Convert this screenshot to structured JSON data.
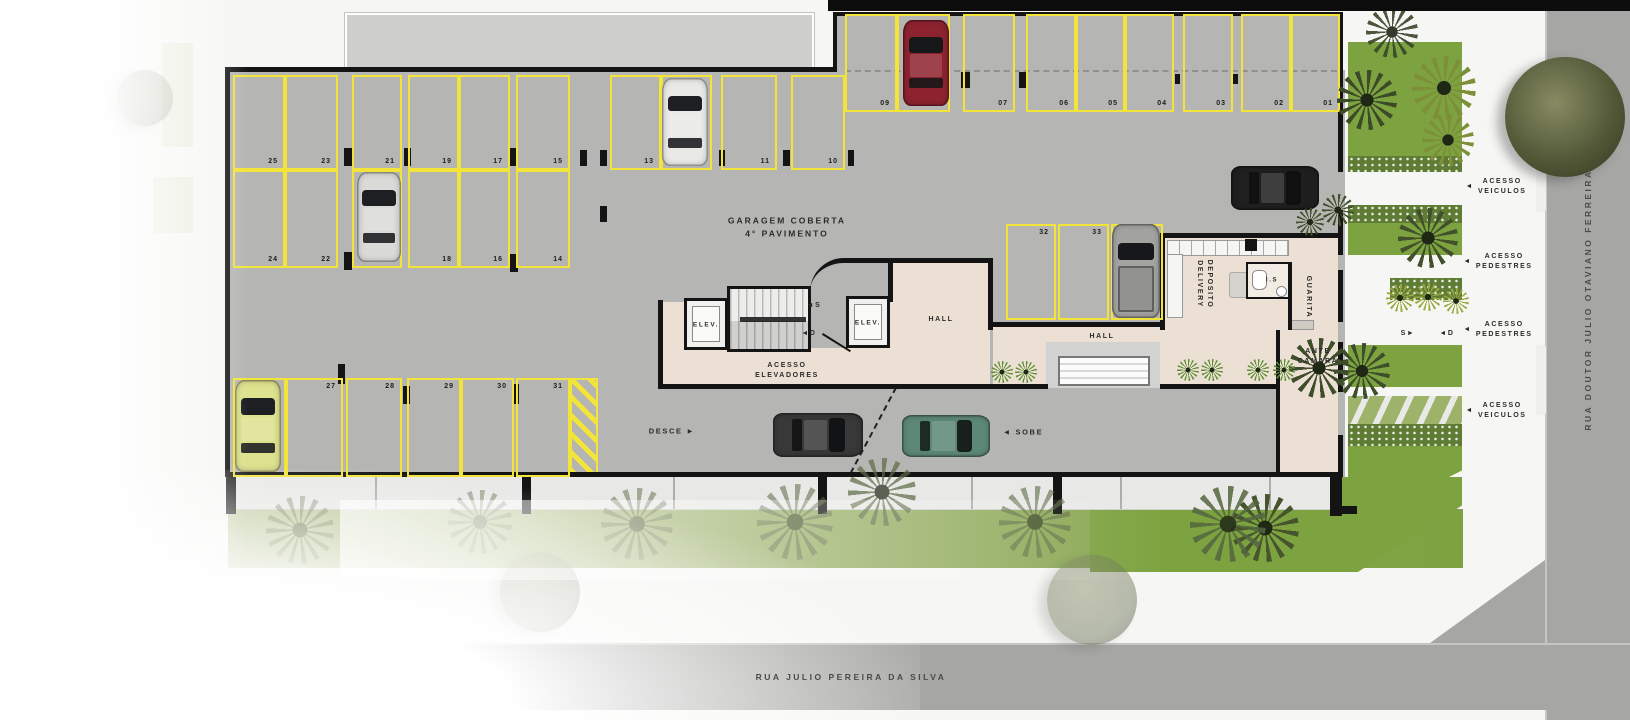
{
  "title": {
    "line1": "GARAGEM COBERTA",
    "line2": "4° PAVIMENTO"
  },
  "streets": {
    "bottom": "RUA JULIO PEREIRA DA SILVA",
    "right": "RUA DOUTOR JULIO OTAVIANO FERREIRA"
  },
  "colors": {
    "parking_line": "#f2e438",
    "floor": "#b5b5b3",
    "interior_floor": "#ebe0d3",
    "lawn": "#7da340",
    "hedge": "#5e7c33",
    "street": "#a6a6a4",
    "wall": "#141414"
  },
  "parking": {
    "spaces": [
      {
        "n": "25",
        "x": 233,
        "y": 75,
        "w": 52,
        "h": 95,
        "lp": "br"
      },
      {
        "n": "23",
        "x": 285,
        "y": 75,
        "w": 53,
        "h": 95,
        "lp": "br"
      },
      {
        "n": "21",
        "x": 352,
        "y": 75,
        "w": 50,
        "h": 95,
        "lp": "br"
      },
      {
        "n": "19",
        "x": 408,
        "y": 75,
        "w": 51,
        "h": 95,
        "lp": "br"
      },
      {
        "n": "17",
        "x": 459,
        "y": 75,
        "w": 51,
        "h": 95,
        "lp": "br"
      },
      {
        "n": "15",
        "x": 516,
        "y": 75,
        "w": 54,
        "h": 95,
        "lp": "br"
      },
      {
        "n": "13",
        "x": 610,
        "y": 75,
        "w": 51,
        "h": 95,
        "lp": "br"
      },
      {
        "n": "12",
        "x": 661,
        "y": 75,
        "w": 51,
        "h": 95,
        "lp": "br"
      },
      {
        "n": "11",
        "x": 721,
        "y": 75,
        "w": 56,
        "h": 95,
        "lp": "br"
      },
      {
        "n": "10",
        "x": 791,
        "y": 75,
        "w": 54,
        "h": 95,
        "lp": "br"
      },
      {
        "n": "24",
        "x": 233,
        "y": 170,
        "w": 52,
        "h": 98,
        "lp": "br"
      },
      {
        "n": "22",
        "x": 285,
        "y": 170,
        "w": 53,
        "h": 98,
        "lp": "br"
      },
      {
        "n": "20",
        "x": 352,
        "y": 170,
        "w": 50,
        "h": 98,
        "lp": "br"
      },
      {
        "n": "18",
        "x": 408,
        "y": 170,
        "w": 51,
        "h": 98,
        "lp": "br"
      },
      {
        "n": "16",
        "x": 459,
        "y": 170,
        "w": 51,
        "h": 98,
        "lp": "br"
      },
      {
        "n": "14",
        "x": 516,
        "y": 170,
        "w": 54,
        "h": 98,
        "lp": "br"
      },
      {
        "n": "26",
        "x": 233,
        "y": 378,
        "w": 53,
        "h": 99,
        "lp": "tr"
      },
      {
        "n": "27",
        "x": 286,
        "y": 378,
        "w": 57,
        "h": 99,
        "lp": "tr"
      },
      {
        "n": "28",
        "x": 346,
        "y": 378,
        "w": 56,
        "h": 99,
        "lp": "tr"
      },
      {
        "n": "29",
        "x": 407,
        "y": 378,
        "w": 54,
        "h": 99,
        "lp": "tr"
      },
      {
        "n": "30",
        "x": 461,
        "y": 378,
        "w": 53,
        "h": 99,
        "lp": "tr"
      },
      {
        "n": "31",
        "x": 516,
        "y": 378,
        "w": 54,
        "h": 99,
        "lp": "tr"
      },
      {
        "n": "32",
        "x": 1006,
        "y": 224,
        "w": 50,
        "h": 96,
        "lp": "tr"
      },
      {
        "n": "33",
        "x": 1058,
        "y": 224,
        "w": 51,
        "h": 96,
        "lp": "tr"
      },
      {
        "n": "34",
        "x": 1111,
        "y": 224,
        "w": 52,
        "h": 96,
        "lp": "tr"
      },
      {
        "n": "09",
        "x": 845,
        "y": 14,
        "w": 52,
        "h": 98,
        "lp": "br"
      },
      {
        "n": "08",
        "x": 897,
        "y": 14,
        "w": 53,
        "h": 98,
        "lp": "br"
      },
      {
        "n": "07",
        "x": 963,
        "y": 14,
        "w": 52,
        "h": 98,
        "lp": "br"
      },
      {
        "n": "06",
        "x": 1026,
        "y": 14,
        "w": 50,
        "h": 98,
        "lp": "br"
      },
      {
        "n": "05",
        "x": 1076,
        "y": 14,
        "w": 49,
        "h": 98,
        "lp": "br"
      },
      {
        "n": "04",
        "x": 1125,
        "y": 14,
        "w": 49,
        "h": 98,
        "lp": "br"
      },
      {
        "n": "03",
        "x": 1183,
        "y": 14,
        "w": 50,
        "h": 98,
        "lp": "br"
      },
      {
        "n": "02",
        "x": 1241,
        "y": 14,
        "w": 50,
        "h": 98,
        "lp": "br"
      },
      {
        "n": "01",
        "x": 1291,
        "y": 14,
        "w": 49,
        "h": 98,
        "lp": "br"
      }
    ]
  },
  "labels": [
    {
      "name": "elev-left-label",
      "text": "ELEV.",
      "x": 706,
      "y": 325,
      "size": 6.5
    },
    {
      "name": "elev-right-label",
      "text": "ELEV.",
      "x": 868,
      "y": 323,
      "size": 6.5
    },
    {
      "name": "stair-up-marker",
      "text": "◄S",
      "x": 814,
      "y": 306,
      "size": 7
    },
    {
      "name": "stair-down-marker",
      "text": "◄D",
      "x": 809,
      "y": 334,
      "size": 7
    },
    {
      "name": "acesso-elevadores-label",
      "lines": [
        "ACESSO",
        "ELEVADORES"
      ],
      "x": 787,
      "y": 371,
      "size": 7
    },
    {
      "name": "hall-label-1",
      "text": "HALL",
      "x": 941,
      "y": 320,
      "size": 7
    },
    {
      "name": "hall-label-2",
      "text": "HALL",
      "x": 1102,
      "y": 337,
      "size": 7
    },
    {
      "name": "deposito-delivery-label",
      "lines": [
        "DEPOSITO",
        "DELIVERY"
      ],
      "x": 1204,
      "y": 284,
      "rot": 90,
      "size": 7
    },
    {
      "name": "is-label",
      "text": "I.S",
      "x": 1272,
      "y": 281,
      "size": 6
    },
    {
      "name": "guarita-label",
      "text": "GUARITA",
      "x": 1308,
      "y": 297,
      "rot": 90,
      "size": 7
    },
    {
      "name": "ante-camara-label",
      "lines": [
        "ANTE",
        "CAMARA"
      ],
      "x": 1318,
      "y": 357,
      "size": 7
    },
    {
      "name": "desce-label",
      "text": "DESCE ►",
      "x": 672,
      "y": 432,
      "size": 7.5
    },
    {
      "name": "sobe-label",
      "text": "◄ SOBE",
      "x": 1023,
      "y": 433,
      "size": 7.5
    },
    {
      "name": "s-walk-marker",
      "text": "S►",
      "x": 1408,
      "y": 334,
      "size": 7
    },
    {
      "name": "d-walk-marker",
      "text": "◄D",
      "x": 1447,
      "y": 334,
      "size": 7
    },
    {
      "name": "acesso-veiculos-top-label",
      "lines": [
        "ACESSO",
        "VEICULOS"
      ],
      "x": 1496,
      "y": 187,
      "arrow": "◄",
      "size": 7
    },
    {
      "name": "acesso-pedestres-1-label",
      "lines": [
        "ACESSO",
        "PEDESTRES"
      ],
      "x": 1498,
      "y": 262,
      "arrow": "◄",
      "size": 7
    },
    {
      "name": "acesso-pedestres-2-label",
      "lines": [
        "ACESSO",
        "PEDESTRES"
      ],
      "x": 1498,
      "y": 330,
      "arrow": "◄",
      "size": 7
    },
    {
      "name": "acesso-veiculos-bottom-label",
      "lines": [
        "ACESSO",
        "VEICULOS"
      ],
      "x": 1496,
      "y": 411,
      "arrow": "◄",
      "size": 7
    }
  ],
  "cars": [
    {
      "name": "car-red-space-08",
      "x": 903,
      "y": 20,
      "w": 46,
      "h": 86,
      "rot": 0,
      "body": "#8e2330",
      "glass": "#17181a"
    },
    {
      "name": "car-white-space-12",
      "x": 662,
      "y": 78,
      "w": 46,
      "h": 88,
      "rot": 0,
      "body": "#e9e9e7",
      "glass": "#1d1f22"
    },
    {
      "name": "car-silver-space-20",
      "x": 357,
      "y": 172,
      "w": 44,
      "h": 90,
      "rot": 0,
      "body": "#dadad8",
      "glass": "#1d1f22"
    },
    {
      "name": "car-yellow-space-26",
      "x": 235,
      "y": 380,
      "w": 46,
      "h": 92,
      "rot": 0,
      "body": "#dee18e",
      "glass": "#1d1f22"
    },
    {
      "name": "pickup-gray-space-34",
      "x": 1112,
      "y": 224,
      "w": 48,
      "h": 94,
      "rot": 0,
      "body": "#a3a3a1",
      "glass": "#17181a",
      "type": "pickup"
    },
    {
      "name": "car-black-driving",
      "x": 1253,
      "y": 144,
      "w": 44,
      "h": 88,
      "rot": 90,
      "body": "#1f1f1f",
      "glass": "#101011"
    },
    {
      "name": "car-dark-ramp-desce",
      "x": 796,
      "y": 390,
      "w": 44,
      "h": 90,
      "rot": 90,
      "body": "#383838",
      "glass": "#121315"
    },
    {
      "name": "car-green-ramp-sobe",
      "x": 925,
      "y": 392,
      "w": 42,
      "h": 88,
      "rot": 90,
      "body": "#5d8876",
      "glass": "#17201c"
    }
  ],
  "trees": [
    {
      "name": "big-street-tree",
      "x": 1565,
      "y": 117,
      "r": 60,
      "kind": "round",
      "c": "#4e5434",
      "o": 1
    },
    {
      "name": "palm",
      "x": 1367,
      "y": 100,
      "r": 30,
      "kind": "palm",
      "c": "#3c4a28",
      "o": 1
    },
    {
      "name": "palm",
      "x": 1444,
      "y": 88,
      "r": 32,
      "kind": "palm",
      "c": "#7e8f39",
      "o": 1
    },
    {
      "name": "palm",
      "x": 1448,
      "y": 140,
      "r": 26,
      "kind": "palm",
      "c": "#7e8f39",
      "o": 1
    },
    {
      "name": "palm",
      "x": 1392,
      "y": 32,
      "r": 26,
      "kind": "palm",
      "c": "#39462a",
      "o": 0.9
    },
    {
      "name": "palm",
      "x": 1310,
      "y": 222,
      "r": 14,
      "kind": "palm",
      "c": "#42512b",
      "o": 1
    },
    {
      "name": "palm",
      "x": 1338,
      "y": 210,
      "r": 16,
      "kind": "palm",
      "c": "#42512b",
      "o": 1
    },
    {
      "name": "palm",
      "x": 1428,
      "y": 238,
      "r": 30,
      "kind": "palm",
      "c": "#42512b",
      "o": 1
    },
    {
      "name": "palm",
      "x": 1400,
      "y": 298,
      "r": 14,
      "kind": "palm",
      "c": "#9aa83f",
      "o": 1
    },
    {
      "name": "palm",
      "x": 1428,
      "y": 297,
      "r": 14,
      "kind": "palm",
      "c": "#9aa83f",
      "o": 1
    },
    {
      "name": "palm",
      "x": 1456,
      "y": 301,
      "r": 13,
      "kind": "palm",
      "c": "#9aa83f",
      "o": 1
    },
    {
      "name": "palm",
      "x": 1319,
      "y": 368,
      "r": 30,
      "kind": "palm",
      "c": "#3e4d2a",
      "o": 1
    },
    {
      "name": "palm",
      "x": 1362,
      "y": 371,
      "r": 28,
      "kind": "palm",
      "c": "#3e4d2a",
      "o": 1
    },
    {
      "name": "palm",
      "x": 1265,
      "y": 528,
      "r": 34,
      "kind": "palm",
      "c": "#46552e",
      "o": 1
    },
    {
      "name": "palm",
      "x": 1228,
      "y": 524,
      "r": 38,
      "kind": "palm",
      "c": "#55663f",
      "o": 0.85
    },
    {
      "name": "palm",
      "x": 1035,
      "y": 522,
      "r": 36,
      "kind": "palm",
      "c": "#5c6a45",
      "o": 0.6
    },
    {
      "name": "palm",
      "x": 882,
      "y": 492,
      "r": 34,
      "kind": "palm",
      "c": "#5c6a45",
      "o": 0.7
    },
    {
      "name": "palm",
      "x": 795,
      "y": 522,
      "r": 38,
      "kind": "palm",
      "c": "#5c6a45",
      "o": 0.55
    },
    {
      "name": "palm",
      "x": 637,
      "y": 524,
      "r": 36,
      "kind": "palm",
      "c": "#5c6a45",
      "o": 0.5
    },
    {
      "name": "palm",
      "x": 480,
      "y": 522,
      "r": 32,
      "kind": "palm",
      "c": "#5c6a45",
      "o": 0.45
    },
    {
      "name": "palm",
      "x": 300,
      "y": 530,
      "r": 34,
      "kind": "palm",
      "c": "#5c6a45",
      "o": 0.4
    },
    {
      "name": "faded-tree",
      "x": 1092,
      "y": 600,
      "r": 45,
      "kind": "round",
      "c": "#6a7355",
      "o": 0.45
    },
    {
      "name": "faded-tree",
      "x": 540,
      "y": 592,
      "r": 40,
      "kind": "round",
      "c": "#6f7859",
      "o": 0.3
    },
    {
      "name": "faded-tree",
      "x": 145,
      "y": 98,
      "r": 28,
      "kind": "round",
      "c": "#7a8263",
      "o": 0.3
    },
    {
      "name": "faded-tree",
      "x": 28,
      "y": 390,
      "r": 40,
      "kind": "round",
      "c": "#7a8263",
      "o": 0.28
    },
    {
      "name": "shrub",
      "x": 1002,
      "y": 372,
      "r": 11,
      "kind": "palm",
      "c": "#5f8f33",
      "o": 1
    },
    {
      "name": "shrub",
      "x": 1026,
      "y": 372,
      "r": 11,
      "kind": "palm",
      "c": "#5f8f33",
      "o": 1
    },
    {
      "name": "shrub",
      "x": 1188,
      "y": 370,
      "r": 11,
      "kind": "palm",
      "c": "#5f8f33",
      "o": 1
    },
    {
      "name": "shrub",
      "x": 1212,
      "y": 370,
      "r": 11,
      "kind": "palm",
      "c": "#5f8f33",
      "o": 1
    },
    {
      "name": "shrub",
      "x": 1258,
      "y": 370,
      "r": 11,
      "kind": "palm",
      "c": "#5f8f33",
      "o": 1
    },
    {
      "name": "shrub",
      "x": 1284,
      "y": 370,
      "r": 11,
      "kind": "palm",
      "c": "#5f8f33",
      "o": 1
    }
  ]
}
